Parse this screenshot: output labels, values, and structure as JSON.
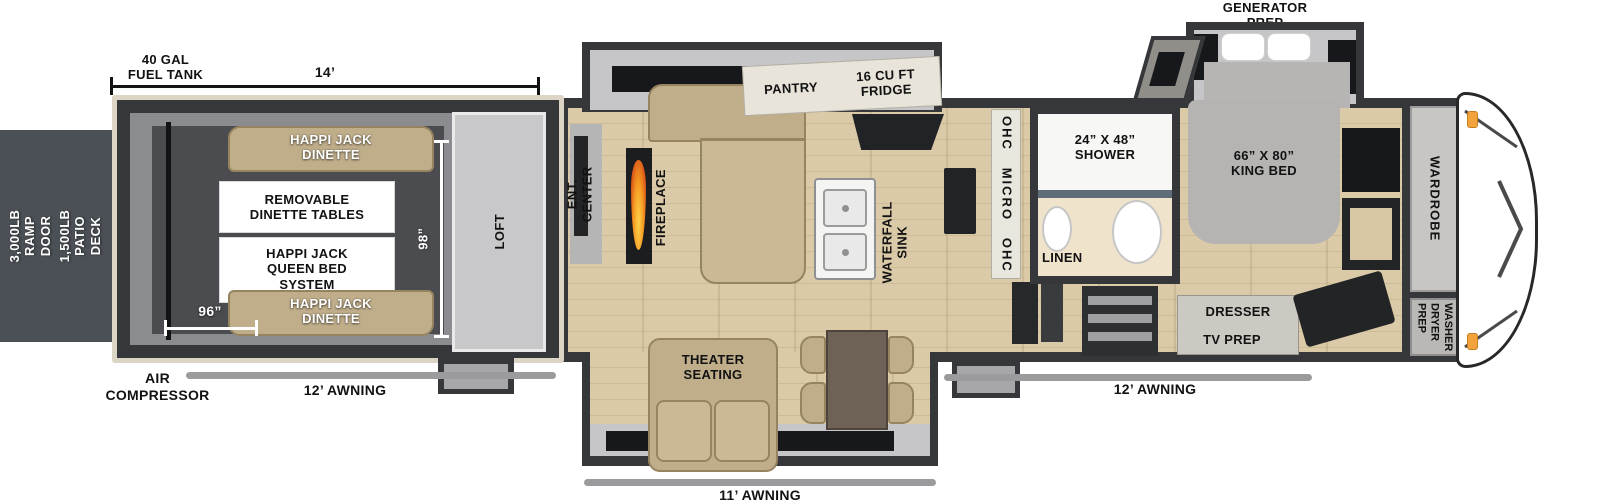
{
  "annotations": {
    "generator_prep": "GENERATOR\nPREP",
    "fuel_tank": "40 GAL\nFUEL TANK",
    "dim_length": "14’",
    "ramp_door": "3,000LB\nRAMP DOOR",
    "patio_deck": "1,500LB\nPATIO DECK",
    "air_compressor": "AIR\nCOMPRESSOR",
    "awning_left": "12’ AWNING",
    "awning_mid": "11’ AWNING",
    "awning_right": "12’ AWNING"
  },
  "garage": {
    "dinette_top": "HAPPI JACK\nDINETTE",
    "removable_tables": "REMOVABLE\nDINETTE TABLES",
    "queen_bed": "HAPPI JACK\nQUEEN BED\nSYSTEM",
    "dinette_bottom": "HAPPI JACK\nDINETTE",
    "dim_width": "96”",
    "dim_height": "98”",
    "loft": "LOFT"
  },
  "living": {
    "ent_center": "ENT. CENTER",
    "fireplace": "FIREPLACE",
    "pantry": "PANTRY",
    "fridge": "16 CU FT\nFRIDGE",
    "waterfall_sink": "WATERFALL\nSINK",
    "ohc_micro": "OHC   MICRO   OHC",
    "theater_seating": "THEATER\nSEATING"
  },
  "bath": {
    "shower": "24” X 48”\nSHOWER",
    "linen": "LINEN"
  },
  "bedroom": {
    "king_bed": "66” X 80”\nKING BED",
    "dresser": "DRESSER",
    "tv_prep": "TV PREP",
    "wardrobe": "WARDROBE",
    "washer_dryer": "WASHER\nDRYER\nPREP"
  },
  "colors": {
    "wall": "#36373a",
    "trim": "#dcd4c4",
    "wood_floor": "#dbcaa8",
    "sofa_tan": "#c0ae8b",
    "garage_mat": "#4b4c50",
    "accent_light": "#f2a33c"
  }
}
